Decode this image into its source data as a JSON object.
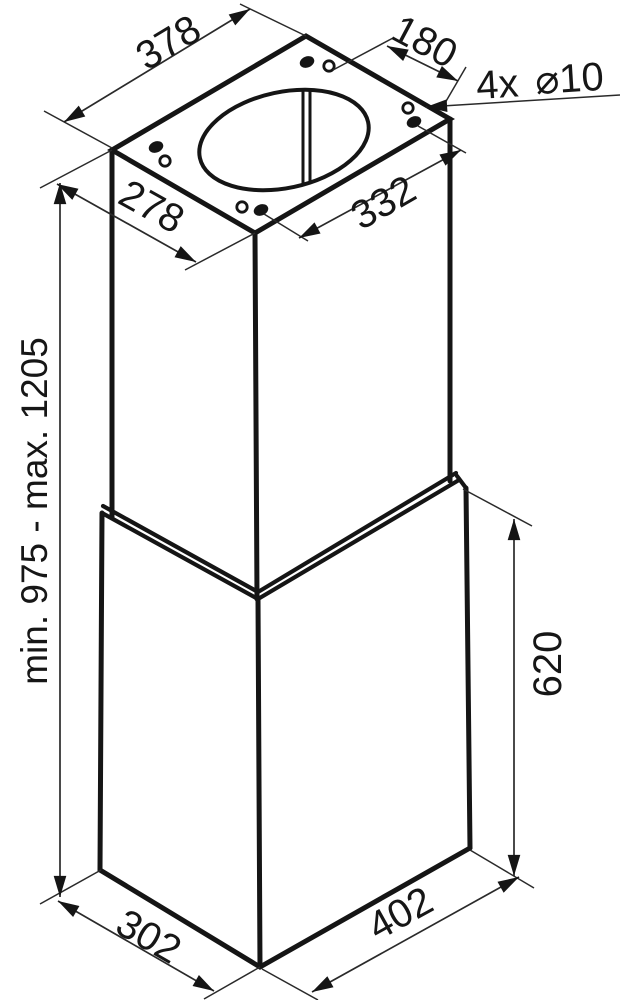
{
  "drawing": {
    "description": "Isometric technical dimension drawing of an island cooker hood (chimney duct over hood body)",
    "stroke_color": "#151515",
    "background": "#ffffff",
    "labels": {
      "top_width": "378",
      "hole_pitch_short": "180",
      "holes_prefix": "4x",
      "holes_size": "⌀10",
      "top_depth": "278",
      "hole_pitch_long": "332",
      "height_range": "min. 975 - max. 1205",
      "lower_section_height": "620",
      "bottom_depth": "302",
      "bottom_width": "402"
    }
  }
}
